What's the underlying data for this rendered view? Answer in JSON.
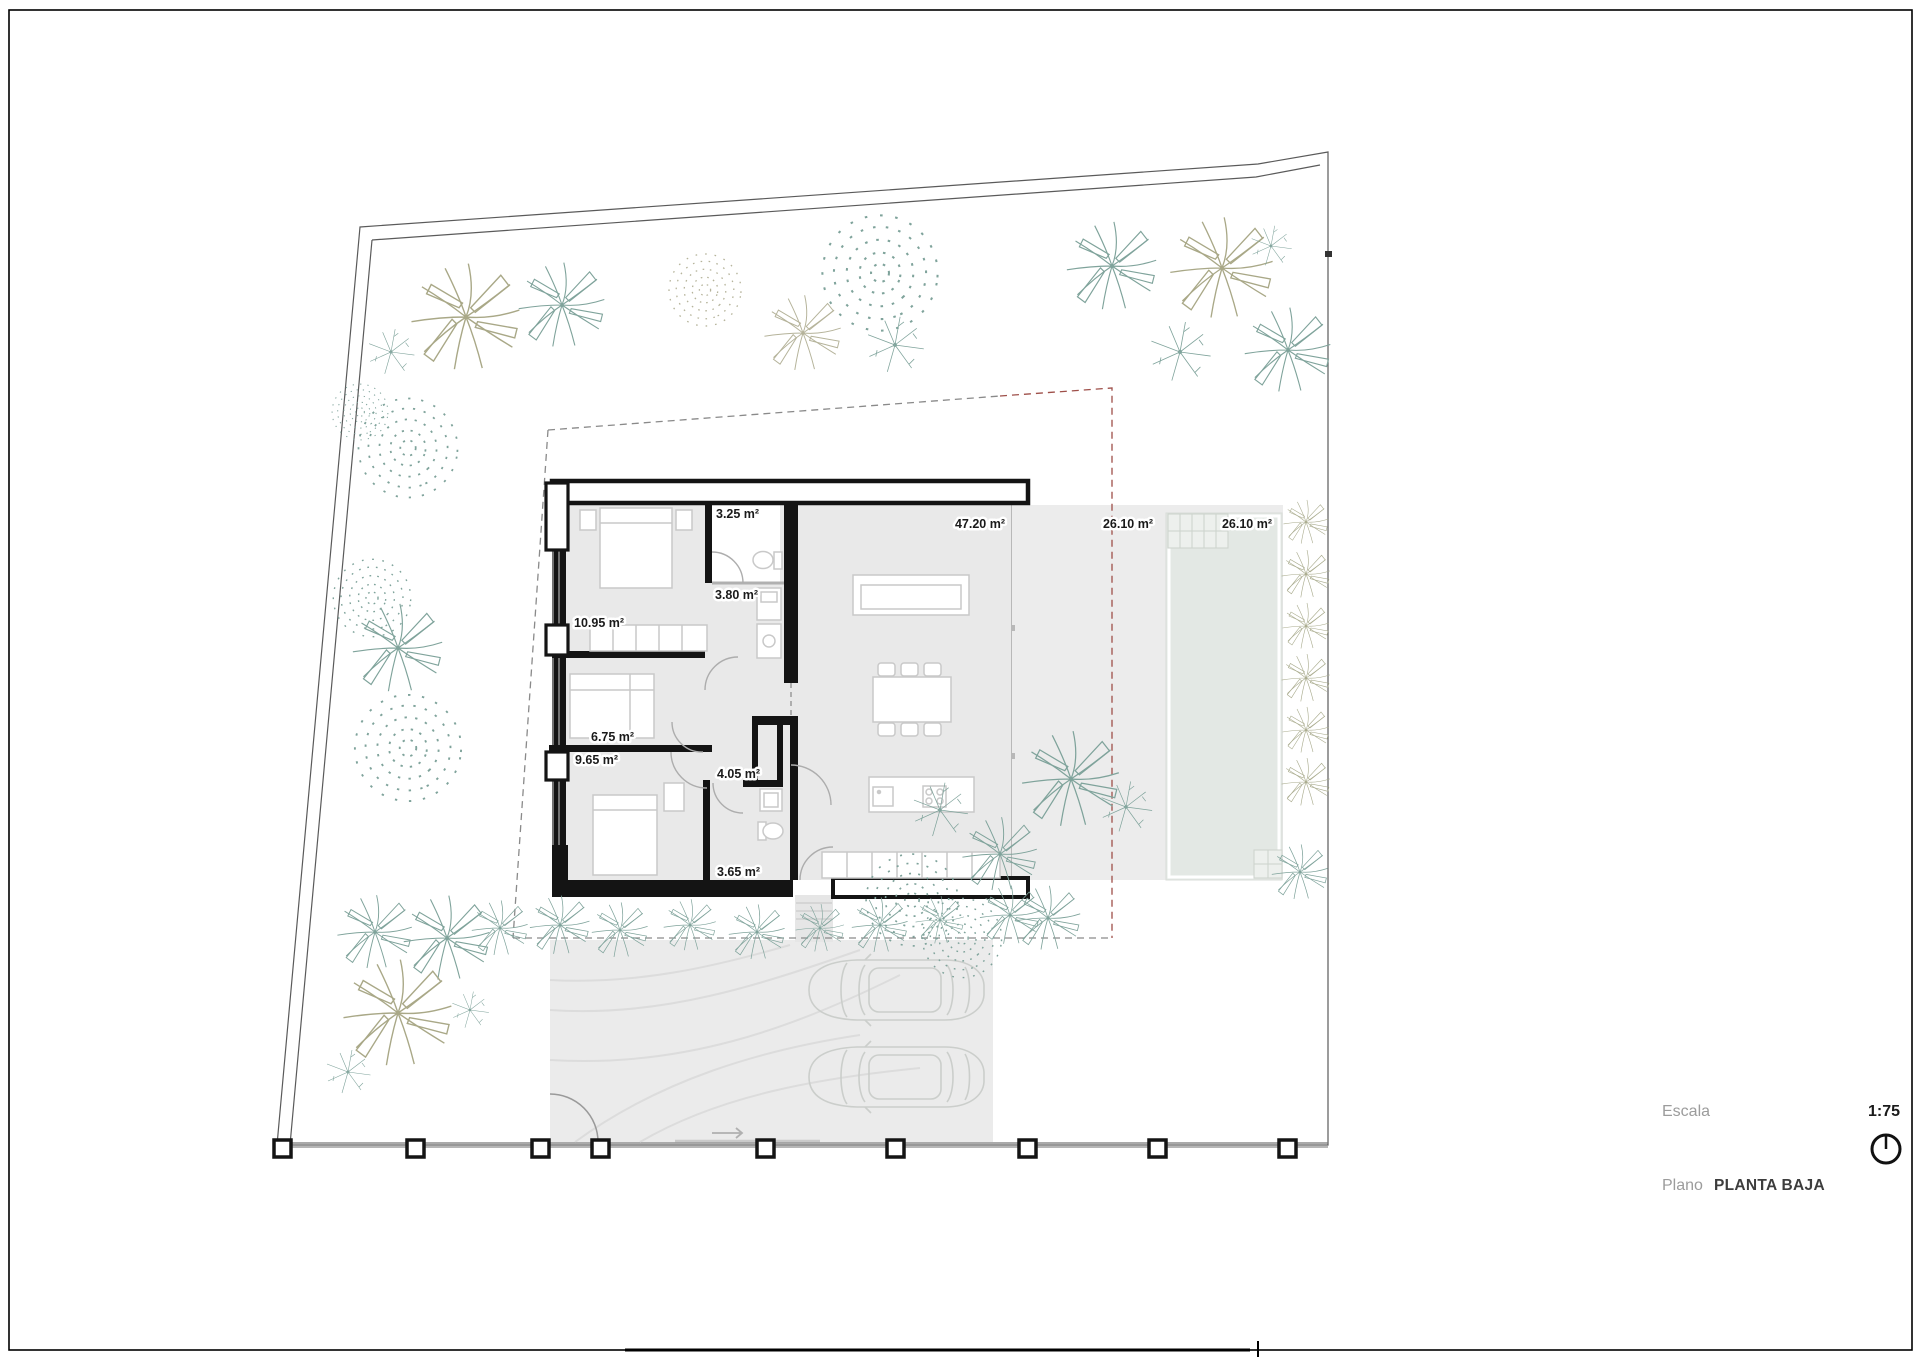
{
  "title_block": {
    "scale_label": "Escala",
    "scale_value": "1:75",
    "plan_label": "Plano",
    "plan_value": "PLANTA BAJA"
  },
  "rooms": [
    {
      "id": "bathroom-1",
      "area": "3.25 m²"
    },
    {
      "id": "bathroom-2",
      "area": "3.80 m²"
    },
    {
      "id": "bedroom-1",
      "area": "10.95 m²"
    },
    {
      "id": "bedroom-2",
      "area": "6.75 m²"
    },
    {
      "id": "bedroom-3",
      "area": "9.65 m²"
    },
    {
      "id": "hallway",
      "area": "4.05 m²"
    },
    {
      "id": "bathroom-3",
      "area": "3.65 m²"
    },
    {
      "id": "living-kitchen",
      "area": "47.20 m²"
    },
    {
      "id": "terrace",
      "area": "26.10 m²"
    },
    {
      "id": "pool",
      "area": "26.10 m²"
    }
  ],
  "icons": {
    "north_indicator": "circle-with-needle"
  },
  "colors": {
    "wall": "#141414",
    "floor": "#e9e9e9",
    "deck": "#ececec",
    "driveway": "#ebebeb",
    "pool": "#e3e8e4",
    "boundary": "#5a5a5a",
    "setback_dash": "#8a8a8a",
    "setback_red": "#9e4f49",
    "tree_teal": "#7fa39b",
    "tree_olive": "#a9a887",
    "furniture_stroke": "#c9c9c9"
  }
}
